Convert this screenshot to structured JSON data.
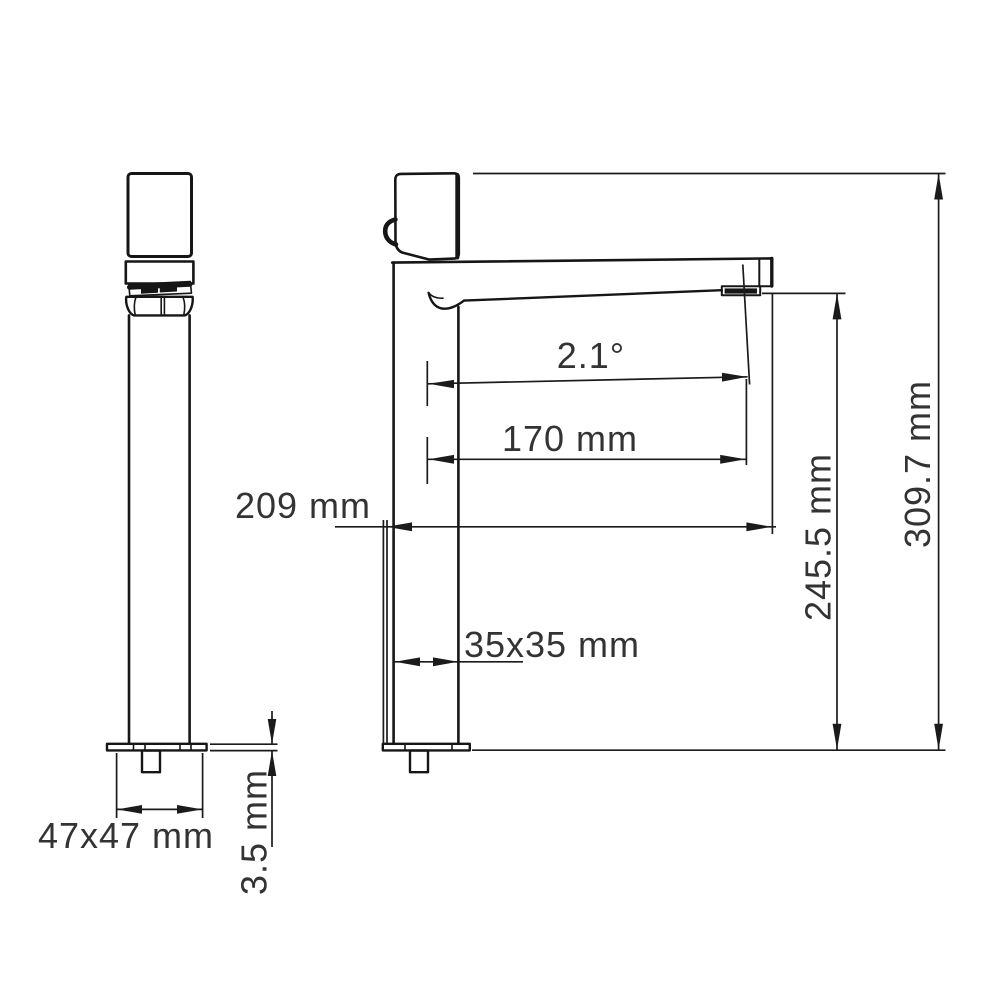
{
  "diagram": {
    "type": "technical-drawing",
    "subject": "single-lever basin mixer faucet, front and side elevation views with dimension annotations",
    "background_color": "#ffffff",
    "line_color": "#161616",
    "text_color": "#333333",
    "labels": {
      "total_height": "309.7 mm",
      "spout_height": "245.5 mm",
      "total_reach": "209 mm",
      "spout_reach": "170 mm",
      "spout_angle": "2.1°",
      "body_section": "35x35 mm",
      "base_section": "47x47 mm",
      "base_thickness": "3.5 mm"
    }
  }
}
